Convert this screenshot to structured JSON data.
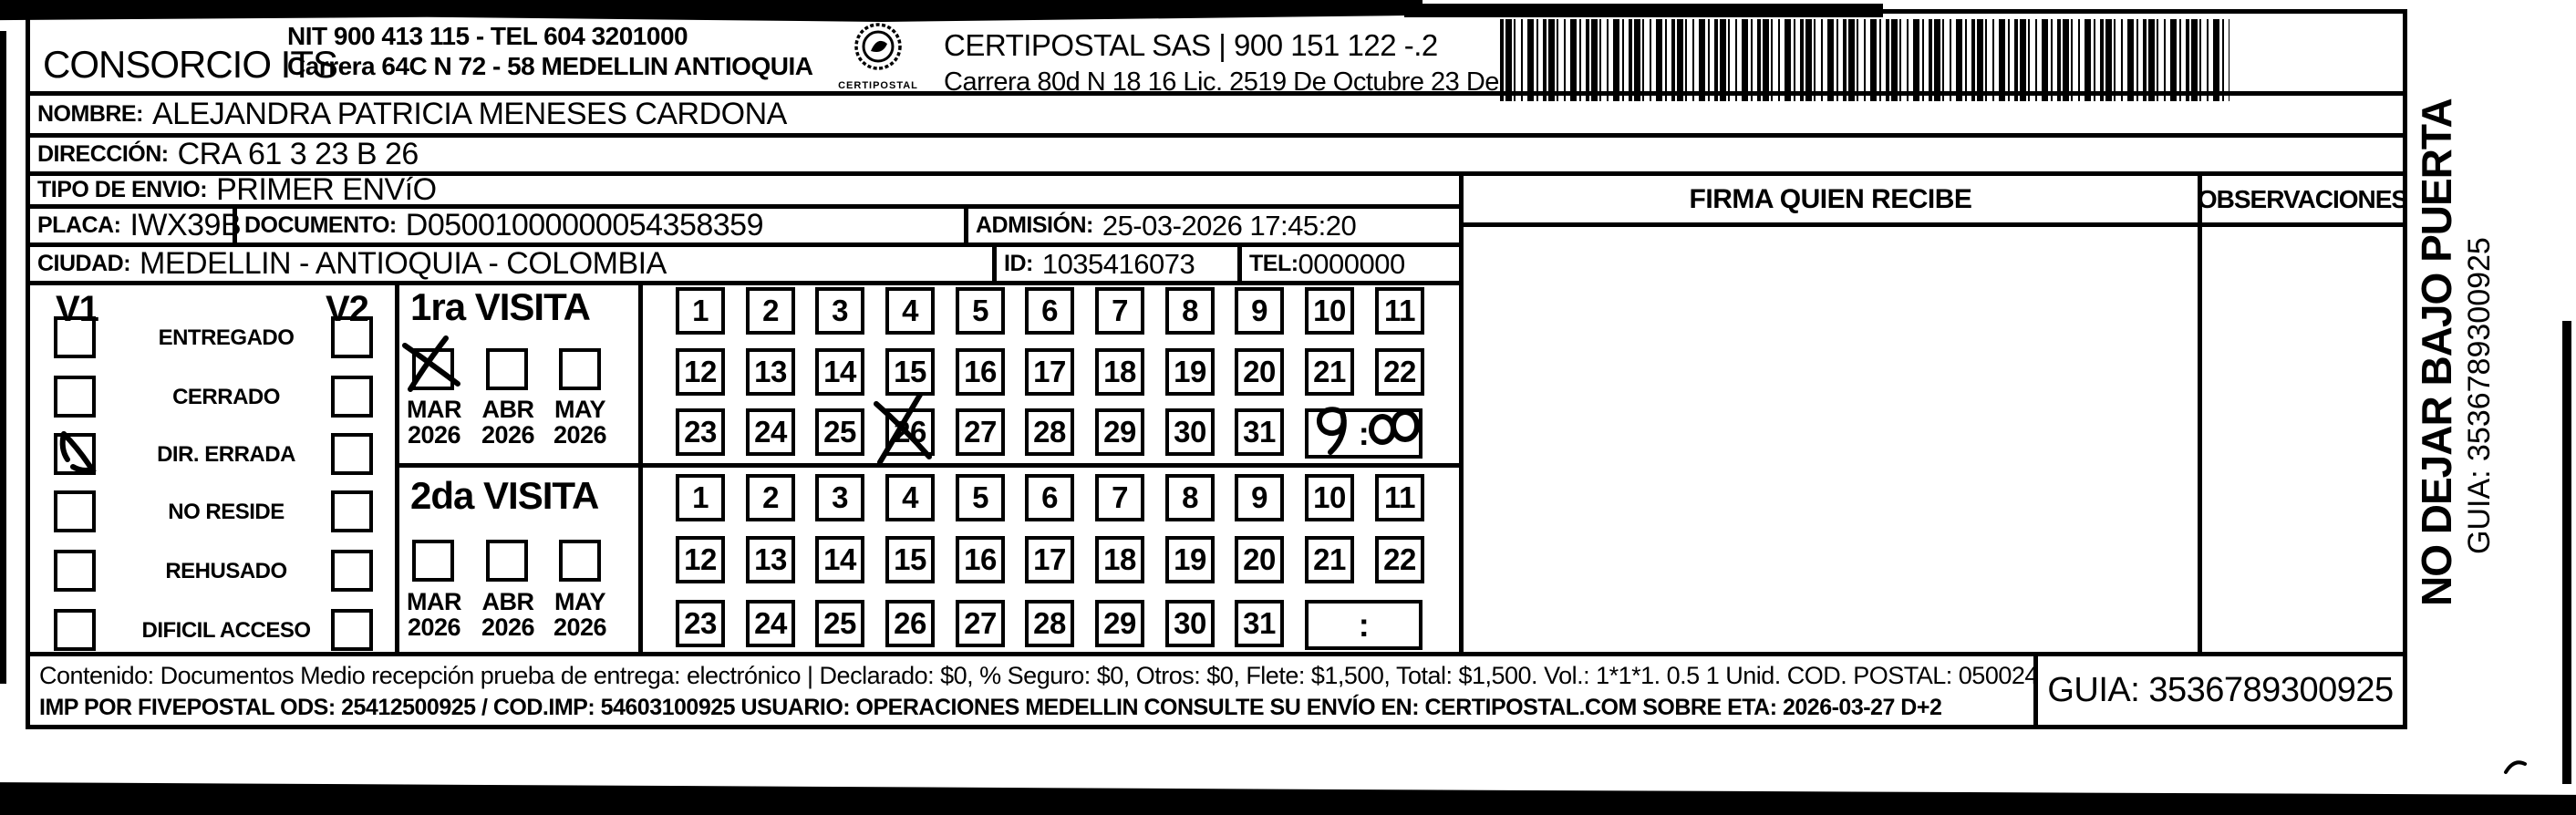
{
  "header": {
    "company": "CONSORCIO ITS",
    "company_info_line1": "NIT 900 413 115 - TEL 604 3201000",
    "company_info_line2": "Carrera 64C N 72 - 58 MEDELLIN ANTIOQUIA",
    "logo_caption": "CERTIPOSTAL",
    "carrier_line1": "CERTIPOSTAL SAS | 900 151 122 -.2",
    "carrier_line2": "Carrera 80d N 18 16  Lic. 2519 De Octubre 23 De 2015"
  },
  "recipient": {
    "nombre_label": "NOMBRE:",
    "nombre": "ALEJANDRA PATRICIA MENESES CARDONA",
    "direccion_label": "DIRECCIÓN:",
    "direccion": "CRA 61 3 23 B  26",
    "tipo_label": "TIPO DE ENVIO:",
    "tipo": "PRIMER ENVíO",
    "placa_label": "PLACA:",
    "placa": "IWX39B",
    "documento_label": "DOCUMENTO:",
    "documento": "D05001000000054358359",
    "admision_label": "ADMISIÓN:",
    "admision": "25-03-2026 17:45:20",
    "ciudad_label": "CIUDAD:",
    "ciudad": "MEDELLIN - ANTIOQUIA - COLOMBIA",
    "id_label": "ID:",
    "id": "1035416073",
    "tel_label": "TEL:",
    "tel": "0000000"
  },
  "signature": {
    "firma_header": "FIRMA QUIEN RECIBE",
    "observaciones_header": "OBSERVACIONES"
  },
  "status": {
    "v1": "V1",
    "v2": "V2",
    "options": [
      "ENTREGADO",
      "CERRADO",
      "DIR. ERRADA",
      "NO RESIDE",
      "REHUSADO",
      "DIFICIL ACCESO"
    ],
    "v1_checked_option": "DIR. ERRADA"
  },
  "visits": {
    "first_label": "1ra VISITA",
    "second_label": "2da VISITA",
    "months": [
      {
        "name": "MAR",
        "year": "2026"
      },
      {
        "name": "ABR",
        "year": "2026"
      },
      {
        "name": "MAY",
        "year": "2026"
      }
    ],
    "first_visit_month_checked": "MAR 2026",
    "days": [
      "1",
      "2",
      "3",
      "4",
      "5",
      "6",
      "7",
      "8",
      "9",
      "10",
      "11",
      "12",
      "13",
      "14",
      "15",
      "16",
      "17",
      "18",
      "19",
      "20",
      "21",
      "22",
      "23",
      "24",
      "25",
      "26",
      "27",
      "28",
      "29",
      "30",
      "31"
    ],
    "first_visit_day_marked": "26",
    "first_visit_time_handwritten": "9:00",
    "time_separator": ":"
  },
  "footer": {
    "line1": "Contenido: Documentos Medio recepción prueba de entrega: electrónico | Declarado: $0, % Seguro: $0, Otros: $0, Flete: $1,500, Total: $1,500. Vol.: 1*1*1. 0.5  1 Unid. COD. POSTAL: 050024",
    "line2": "IMP POR FIVEPOSTAL ODS: 25412500925 / COD.IMP: 54603100925 USUARIO: OPERACIONES MEDELLIN CONSULTE SU ENVÍO EN: CERTIPOSTAL.COM SOBRE ETA: 2026-03-27 D+2",
    "guia": "GUIA: 3536789300925"
  },
  "sidebar": {
    "warning": "NO DEJAR BAJO PUERTA",
    "guia": "GUIA: 3536789300925"
  }
}
